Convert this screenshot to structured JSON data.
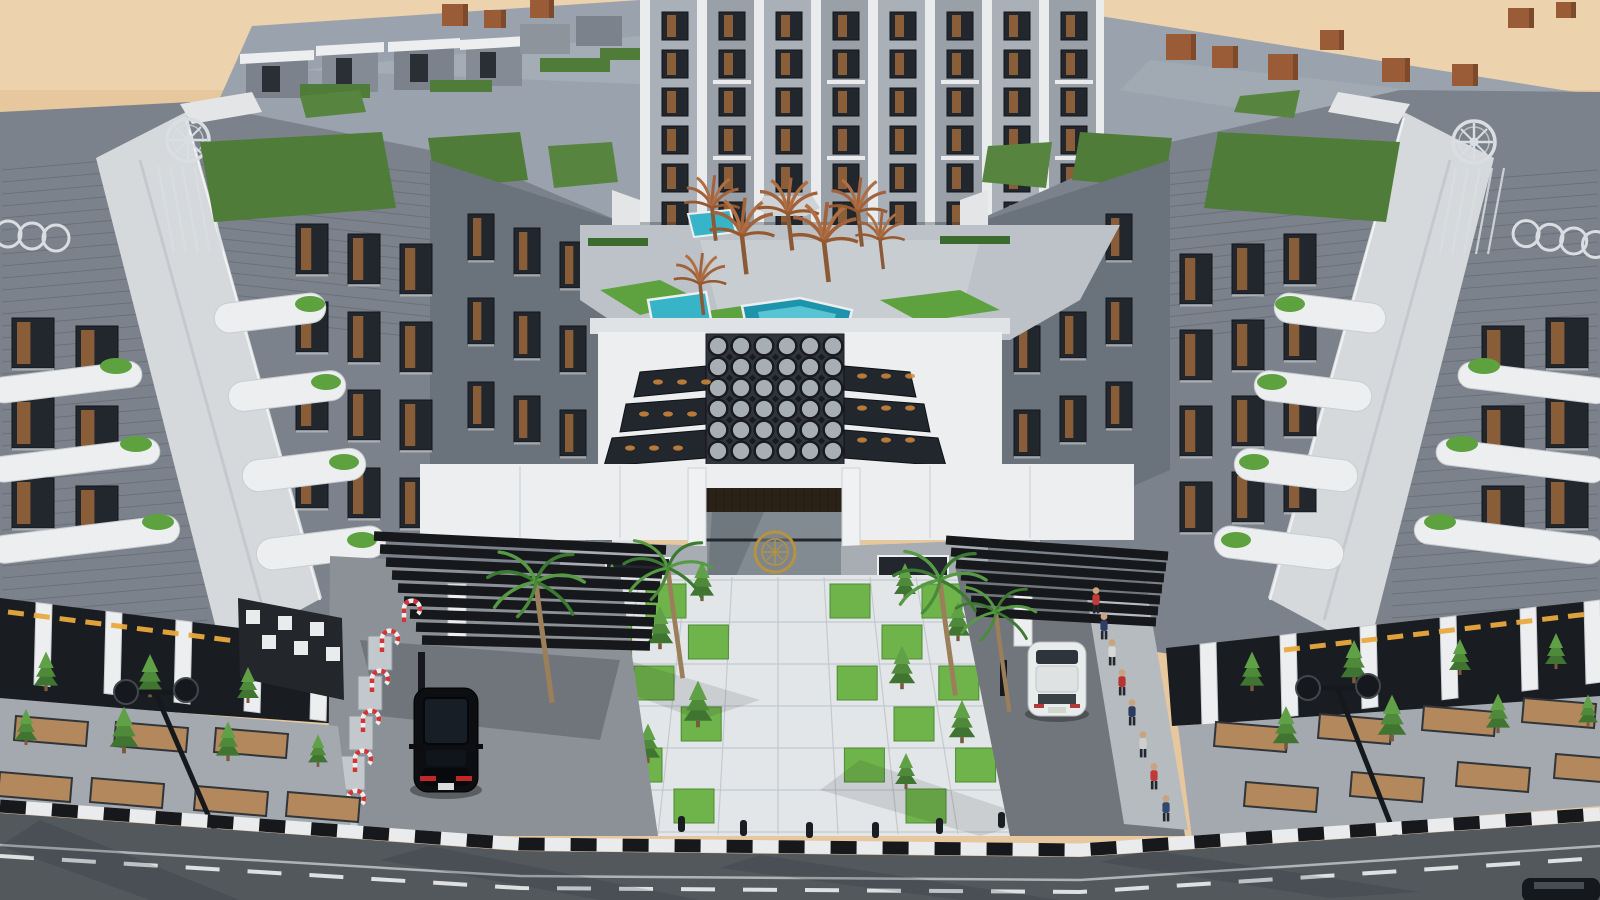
{
  "scene": {
    "type": "3d-architectural-exterior-render",
    "view": "aerial-three-quarter",
    "setting": "desert compound",
    "description": "Aerial render of a modern U-shaped residential apartment compound with grey ribbed facades, white curved balconies, rooftop lawns, a central courtyard with turquoise pools and dry palm sculptures, an octagon-pattern glass court over a gated entrance, a white paved plaza with checkerboard grass squares, palm-lined driveways with louvred black canopies, and a street with striped curb in surrounding sand.",
    "buildings": {
      "left_wing": "five-storey wing with corner tower and compass-wheel ornament",
      "right_wing": "mirrored five-storey wing with corner tower and compass-wheel ornament",
      "back_block": "rear apartment block with white piers and wood windows",
      "ring_frieze": "interlocking-ring relief band on both street towers",
      "rooftop": "penthouse boxes, lawn terraces and brick chimneys on the perimeter roof"
    },
    "courtyard": {
      "pools": 3,
      "dry_palms": 7,
      "umbrella": 1,
      "skylight": "octagon glass court",
      "stepped_skylights": 6
    },
    "entrance": {
      "portal": "dark wood gate",
      "floor_medallion": "bronze circular emblem",
      "plaza_grass_pattern": "checkerboard",
      "bollards": 8
    },
    "vehicles": {
      "black_suv": "left driveway",
      "white_crossover": "right driveway",
      "partial_dark_car": "bottom right street"
    },
    "street": {
      "lamps": 2,
      "curb": "black-white striped",
      "markings": "white dashed centre line",
      "people_count": 8
    },
    "people_shirt_colors": [
      "#c23b3b",
      "#2d3f66",
      "#d8d8d8",
      "#b8322f",
      "#2b3a5f",
      "#cfcfcf",
      "#bf3a36",
      "#31486e"
    ]
  },
  "palette": {
    "sand": "#e7c79e",
    "sand_light": "#f2ddb9",
    "rock": "#8f6f50",
    "roof": "#9aa3ad",
    "roof_shade": "#8a939e",
    "facade_dark": "#596069",
    "facade_mid": "#7b828b",
    "facade_rib": "#3f454c",
    "concrete_light": "#d6d9dc",
    "white": "#eceeef",
    "wood": "#96653a",
    "wood_dark": "#5f4326",
    "glass": "#22272e",
    "green_roof": "#4f7c38",
    "lawn": "#5da23f",
    "lawn_bright": "#6fb44a",
    "hedge": "#3c6b2e",
    "pool": "#38b4c9",
    "pool_deep": "#1e93ac",
    "plaza": "#e3e6e8",
    "plaza_line": "#bcc3c8",
    "driveway": "#8b9196",
    "driveway_shade": "#70767c",
    "sidewalk": "#a3a9af",
    "soil": "#b3885c",
    "road": "#53585d",
    "curb_white": "#e9ebec",
    "curb_black": "#16181c",
    "canopy": "#16181c",
    "suv": "#0c0e11",
    "car_white": "#e9ecec",
    "silver": "#d9dee2",
    "gold": "#b9923f",
    "signage_gold": "#e9a93e",
    "brick": "#9a5c36",
    "trunk": "#9b7f5b",
    "palm_green": "#4a8a38",
    "dry_palm": "#a2633c",
    "shadow": "#20242a"
  }
}
